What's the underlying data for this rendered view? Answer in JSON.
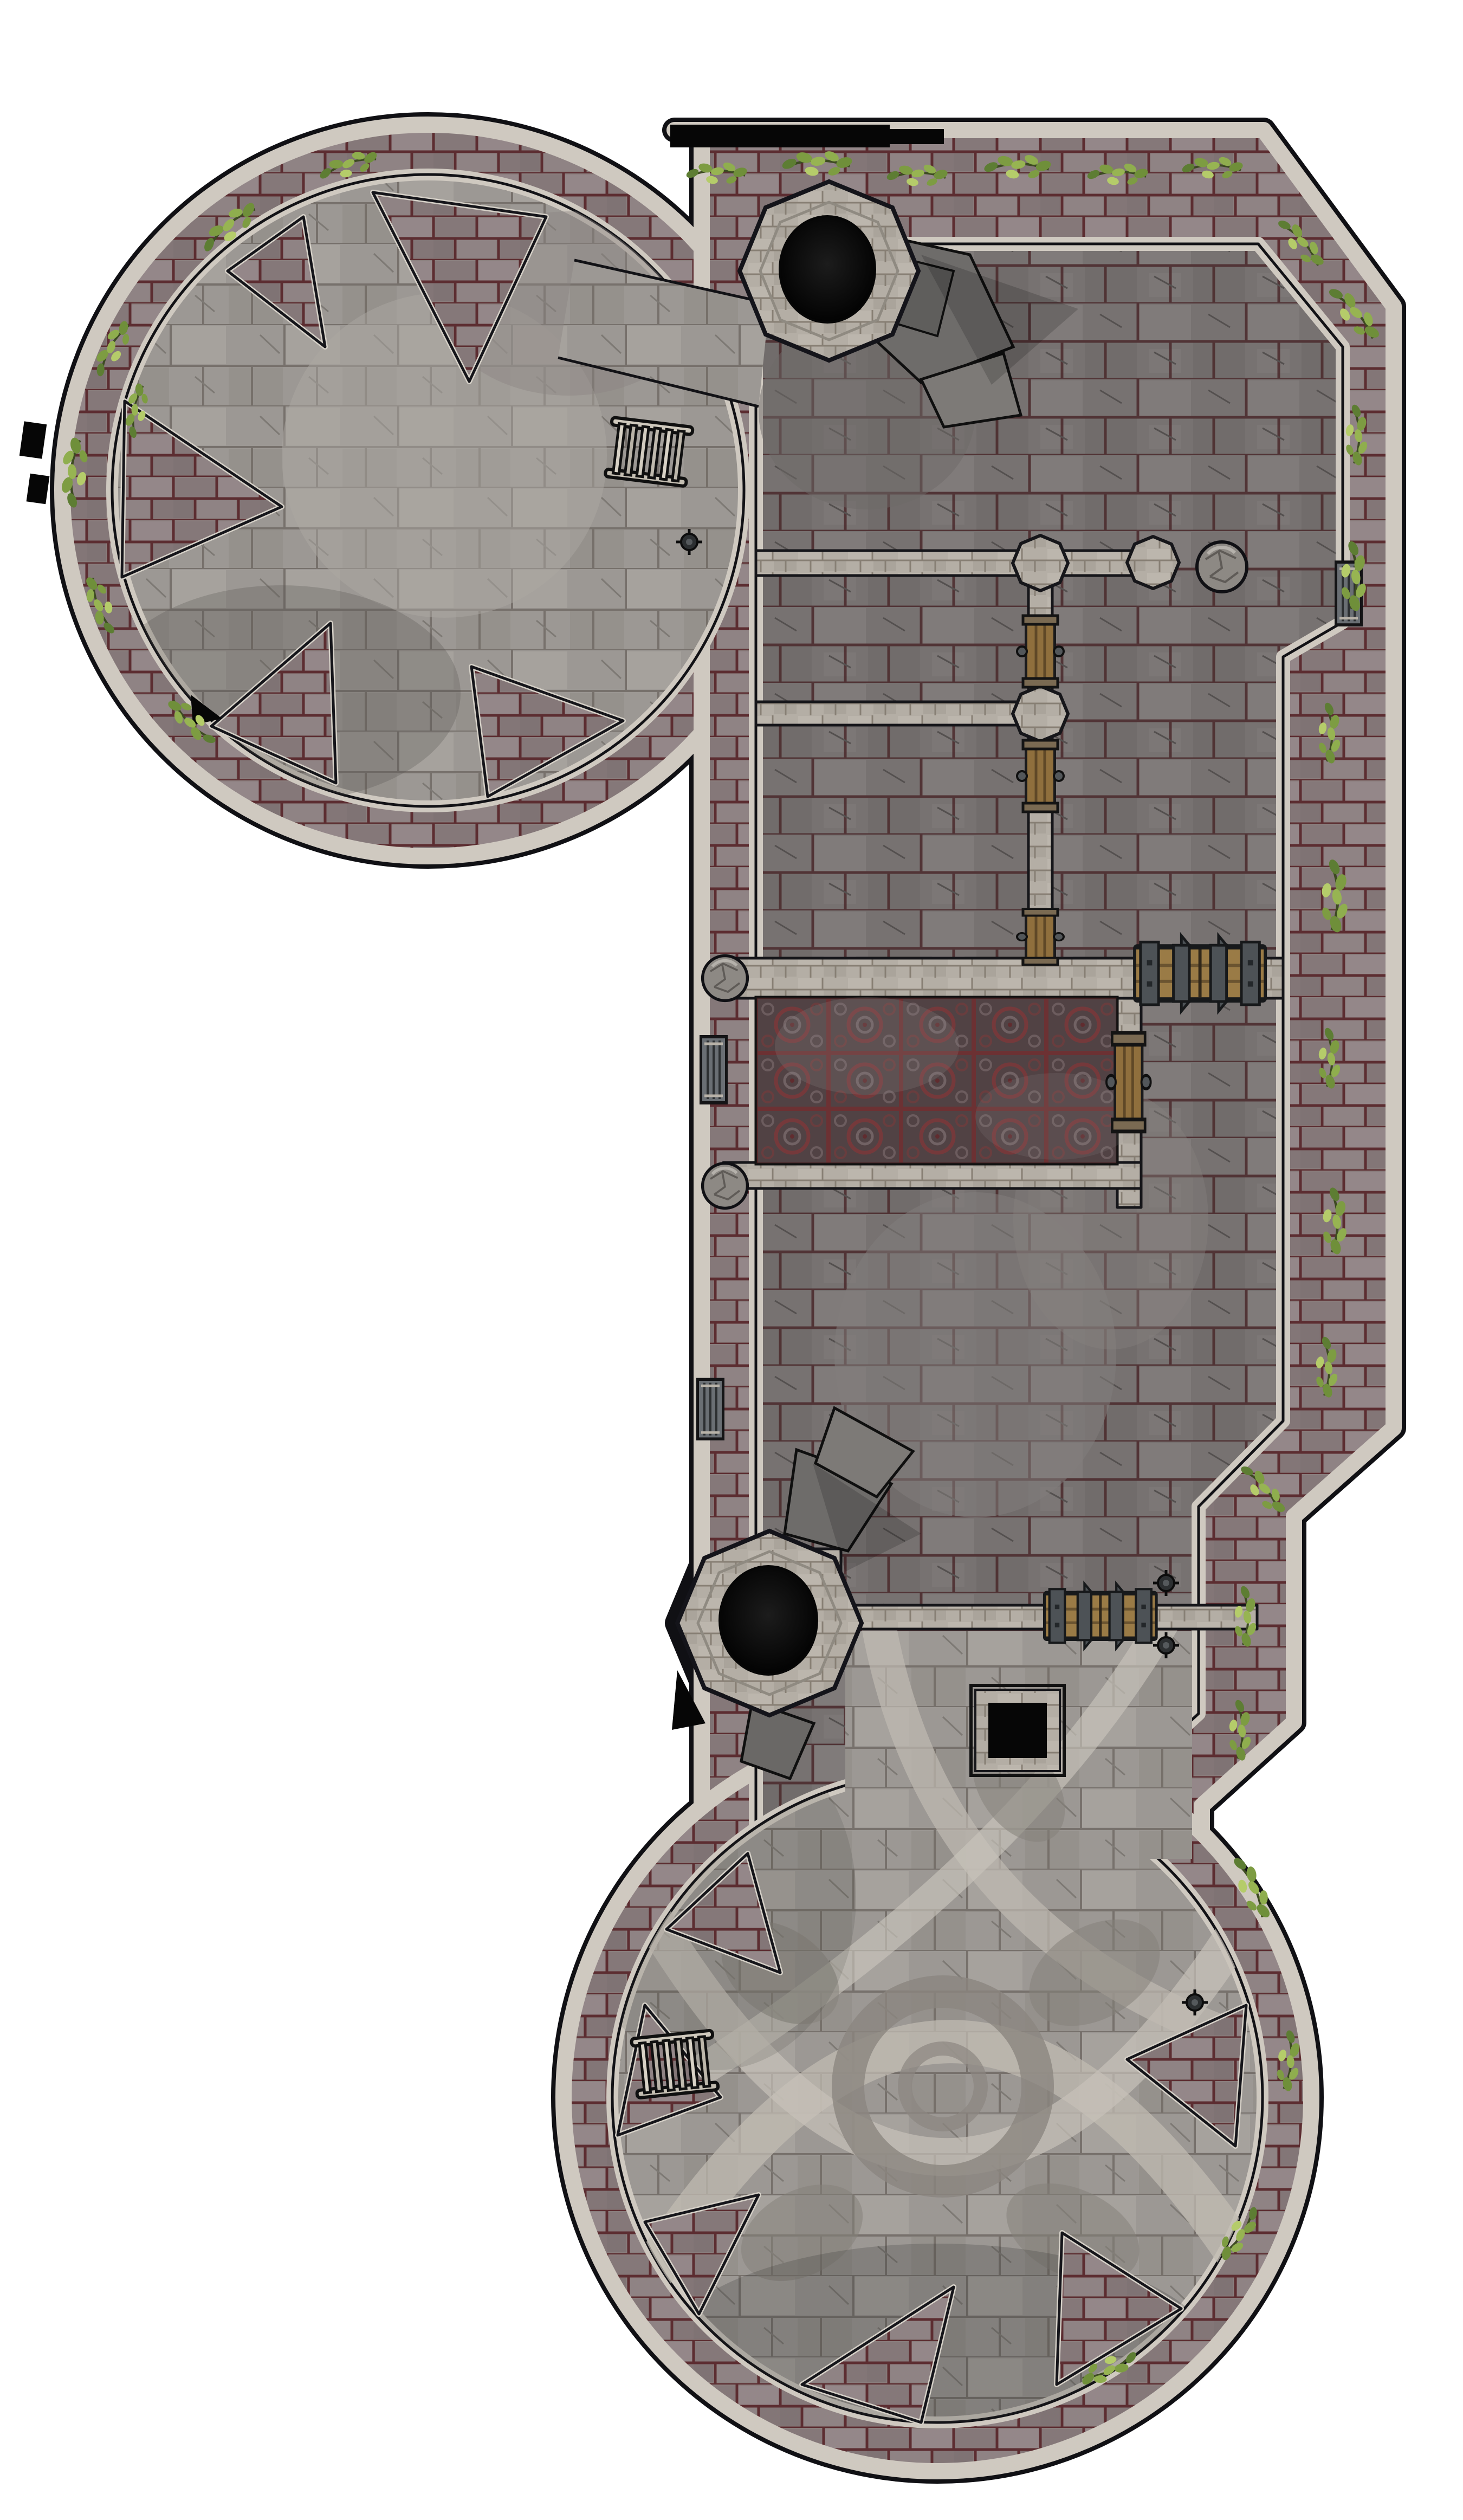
{
  "map": {
    "kind": "fantasy battle map, top-down",
    "subject": "ruined stone keep with two round towers, two well turrets, halls and ramparts",
    "background": "#ffffff",
    "outline": "#101014"
  },
  "palette": {
    "rampart": "#8a7e7d",
    "rampart_mortar": "#5c2d31",
    "wall_light": "#b4aea5",
    "trim_light": "#cfc9c0",
    "edge_dark": "#121216",
    "floor_hall": "#777271",
    "floor_grout": "#472427",
    "floor_pale": "#9c9894",
    "ornate_light": "#c0bbb2",
    "ornate_mottle": "#8b8680",
    "carpet_base": "#4e4547",
    "carpet_knot": "#7b3a3c",
    "wood": "#9a7b46",
    "wood_dark": "#6b5430",
    "metal": "#4d5256",
    "boulder": "#8d8984",
    "rubble": "#6e6c6a",
    "leaf": "#8fae4e",
    "leaf_dark": "#5d7d33",
    "black": "#060606"
  },
  "features": {
    "north_tower": {
      "label": "large round tower (north-west)",
      "floor": "pale cracked flagstones",
      "wall_notches": 5
    },
    "south_tower": {
      "label": "large round tower (south)",
      "floor": "pale flagstones with giant ornate knotwork star",
      "wall_notches": 6
    },
    "keep_hall": {
      "label": "rectangular keep with chamfered corners",
      "floor": "dark grey flagstones with red mortar"
    },
    "carpet_room": {
      "label": "chamber with dark red engraved knotwork tiles",
      "tiles_cols": 5,
      "tiles_rows": 3
    },
    "wells": [
      {
        "id": "north-well-turret",
        "label": "octagonal turret with round shaft opening"
      },
      {
        "id": "south-well-turret",
        "label": "octagonal turret with round shaft opening"
      }
    ],
    "doors": [
      {
        "id": "great-door-east",
        "type": "iron-banded double door",
        "orientation": "horizontal"
      },
      {
        "id": "great-door-south",
        "type": "iron-banded double door",
        "orientation": "horizontal"
      },
      {
        "id": "cell-door-1",
        "type": "plank door",
        "orientation": "vertical"
      },
      {
        "id": "cell-door-2",
        "type": "plank door",
        "orientation": "vertical"
      },
      {
        "id": "cell-door-3",
        "type": "plank door",
        "orientation": "vertical"
      },
      {
        "id": "carpet-room-side-door",
        "type": "plank door",
        "orientation": "vertical"
      },
      {
        "id": "west-wall-door-1",
        "type": "narrow gate",
        "orientation": "vertical"
      },
      {
        "id": "west-wall-door-2",
        "type": "narrow gate",
        "orientation": "vertical"
      },
      {
        "id": "east-wall-door",
        "type": "narrow gate",
        "orientation": "vertical"
      }
    ],
    "ladders": [
      {
        "id": "north-tower-ladder",
        "location": "east rim of north tower"
      },
      {
        "id": "south-tower-ladder",
        "location": "west rim of south tower"
      }
    ],
    "hazards": [
      {
        "id": "floor-pit",
        "label": "square black pit with stone curb"
      },
      {
        "id": "north-gate-opening",
        "label": "dark gateway opening in north wall"
      }
    ],
    "rubble_stairs": [
      {
        "id": "north-turret-rubble",
        "location": "south-east of north well turret"
      },
      {
        "id": "south-turret-rubble",
        "location": "north-east of south well turret"
      }
    ],
    "sconces": 4,
    "vegetation": {
      "type": "ivy clusters",
      "location": "along ramparts and tower rims"
    }
  }
}
